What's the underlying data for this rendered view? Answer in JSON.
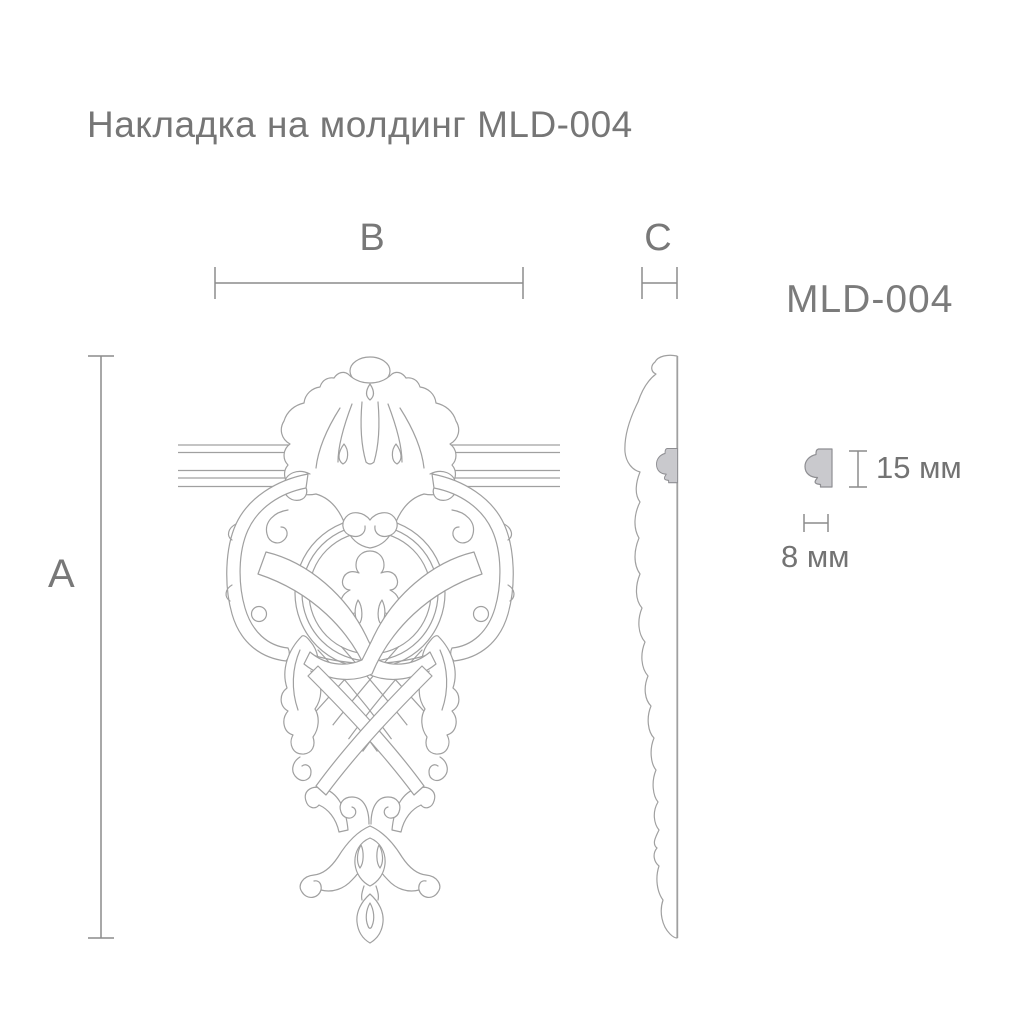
{
  "title": "Накладка на молдинг MLD-004",
  "product_code": "MLD-004",
  "dimension_labels": {
    "width": "B",
    "height": "A",
    "depth": "C"
  },
  "profile_detail": {
    "height": "15 мм",
    "width": "8 мм"
  },
  "colors": {
    "background": "#ffffff",
    "ornament_line": "#a0a0a0",
    "dimension_line": "#8c8c8c",
    "text": "#787878",
    "profile_fill": "#c9c9cd",
    "profile_stroke": "#8e8e92"
  }
}
